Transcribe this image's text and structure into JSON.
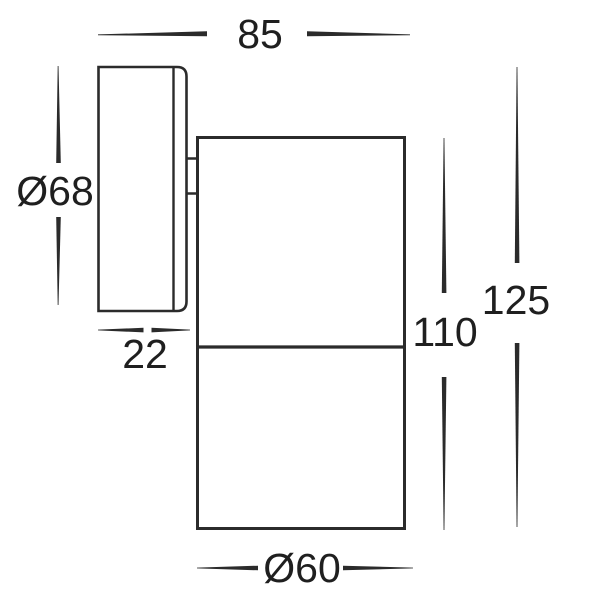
{
  "drawing": {
    "background_color": "#ffffff",
    "line_color": "#2b2b2b",
    "text_color": "#1f1f1f",
    "dimension_labels": {
      "overall_projection": "85",
      "backplate_diameter": "Ø68",
      "backplate_depth": "22",
      "body_length": "110",
      "overall_length": "125",
      "body_diameter": "Ø60"
    }
  }
}
